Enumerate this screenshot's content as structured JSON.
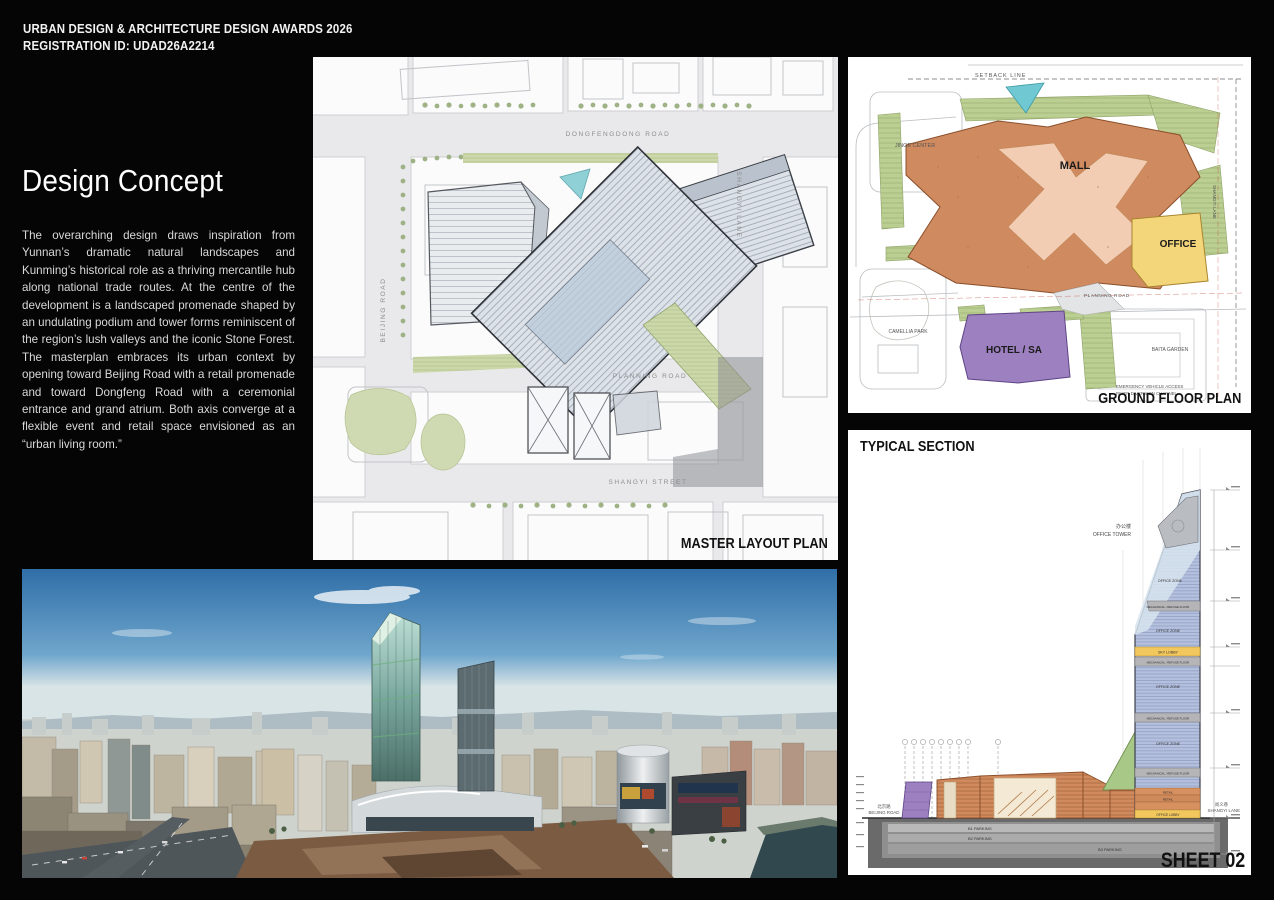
{
  "header": {
    "line1": "URBAN DESIGN & ARCHITECTURE DESIGN AWARDS 2026",
    "line2": "REGISTRATION ID: UDAD26A2214"
  },
  "concept": {
    "title": "Design Concept",
    "body": "The overarching design draws inspiration from Yunnan’s dramatic natural landscapes and Kunming’s historical role as a thriving mercantile hub along national trade routes. At the centre of the development is a landscaped promenade shaped by an undulating podium and tower forms reminiscent of the region’s lush valleys and the iconic Stone Forest. The masterplan embraces its urban context by opening toward Beijing Road with a retail promenade and toward Dongfeng Road with a ceremonial entrance and grand atrium. Both axis converge at a flexible event and retail space envisioned as an “urban living room.”"
  },
  "master_plan": {
    "caption": "MASTER LAYOUT PLAN",
    "roads": {
      "top": "DONGFENGDONG ROAD",
      "left": "BEIJING ROAD",
      "right": "SHANGYI LANE",
      "middle": "PLANNING ROAD",
      "bottom": "SHANGYI STREET"
    }
  },
  "ground_plan": {
    "caption": "GROUND FLOOR PLAN",
    "labels": {
      "setback": "SETBACK LINE",
      "jinge": "JINGE CENTER",
      "mall": "MALL",
      "office": "OFFICE",
      "hotel": "HOTEL / SA",
      "camellia": "CAMELLIA PARK",
      "baita": "BAITA GARDEN",
      "planning_road": "PLANNING ROAD",
      "shangyi_lane": "SHANGYI LANE",
      "note1": "EMERGENCY VEHICLE ACCESS",
      "note2": "RIVER DIVERSION CHANNEL"
    }
  },
  "section": {
    "title": "TYPICAL SECTION",
    "tower_cn": "办公楼",
    "tower_en": "OFFICE TOWER",
    "bands": {
      "office_zone": "OFFICE ZONE",
      "mechanical": "MECHANICAL / REFUGE FLOOR",
      "sky_lobby": "SKY LOBBY",
      "retail": "RETAIL",
      "office_lobby": "OFFICE LOBBY",
      "b1": "B1 PARKING",
      "b2": "B2 PARKING",
      "b3": "B3 PARKING"
    },
    "left_road_cn": "北京路",
    "left_road": "BEIJING ROAD",
    "right_road_cn": "尚义巷",
    "right_road": "SHANGYI LANE"
  },
  "sheet": {
    "caption": "SHEET 02"
  },
  "colors": {
    "background": "#050505",
    "panel": "#ffffff",
    "mall": "#cf8a60",
    "mall_promenade": "#f2ccb3",
    "office": "#f3d679",
    "hotel": "#9d80c0",
    "landscape": "#b7cc8e",
    "water": "#6fc8d2",
    "tower_glass": "#b4c0de",
    "mechanical_band": "#b5b5b8",
    "sky_lobby_band": "#f2c75e",
    "podium_retail": "#d08a5e",
    "basement": "#6a6a6a",
    "sky_top": "#2f6ea7",
    "sky_horizon": "#d8e4e6"
  }
}
